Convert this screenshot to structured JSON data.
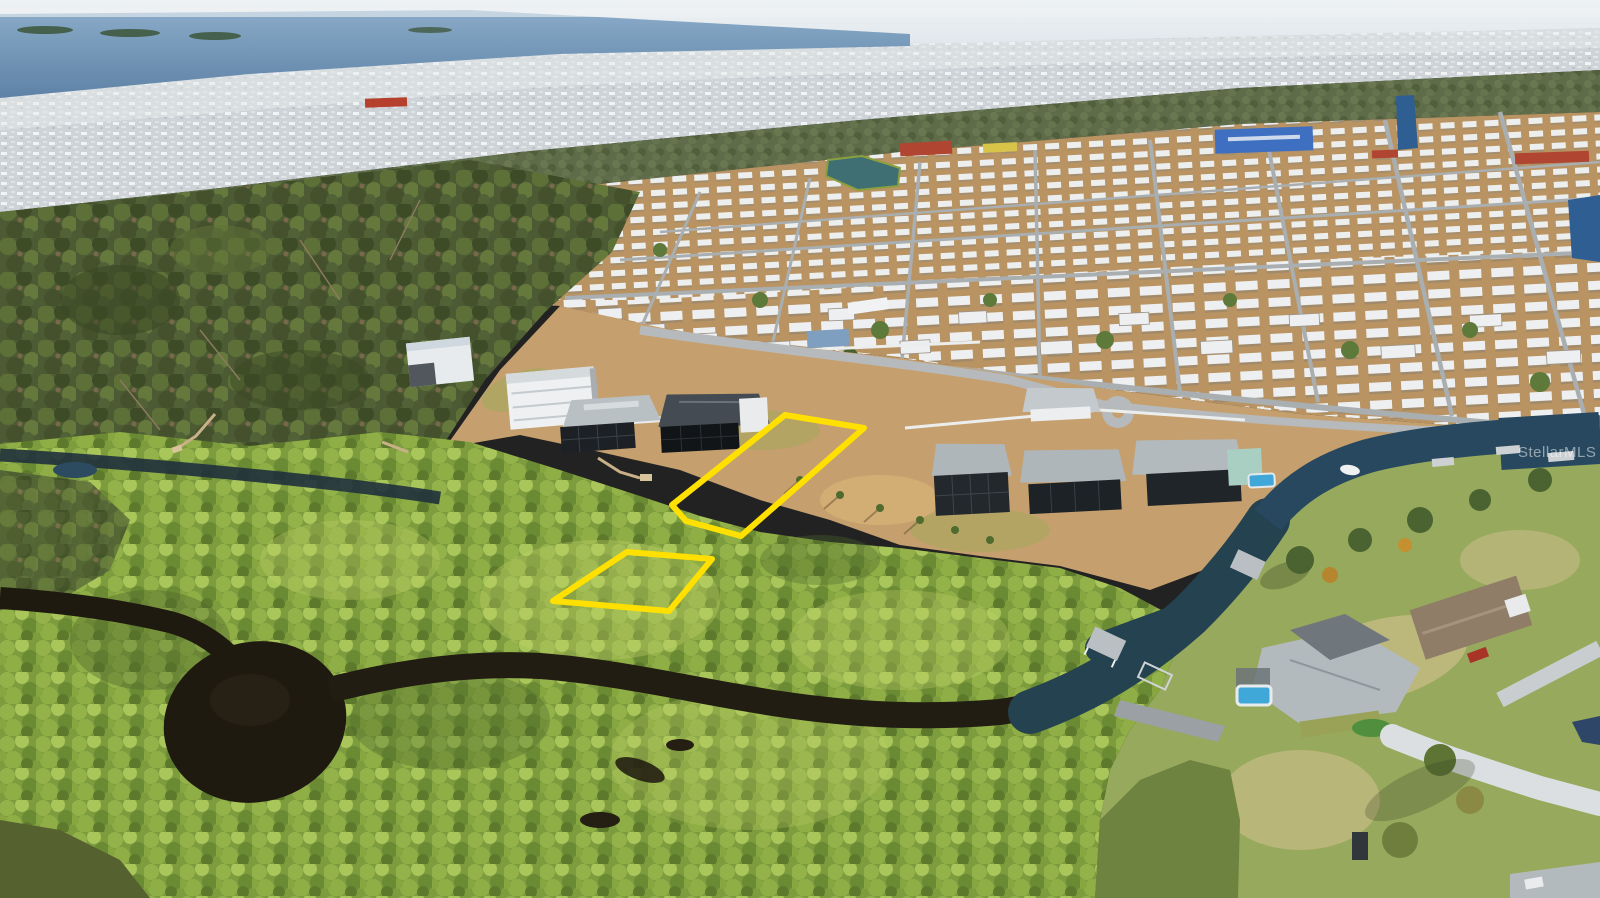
{
  "scene": {
    "type": "aerial-drone-photo",
    "watermark": {
      "text": "StellarMLS"
    },
    "highlight": {
      "color": "#FFE000",
      "lots": {
        "upper": {
          "points": "785,415 864,428 741,536 686,521 672,505"
        },
        "lower": {
          "points": "553,601 627,552 712,559 669,611"
        }
      }
    },
    "palette": {
      "sky_haze": "#E7EDF1",
      "bay_water": "#6E93B6",
      "distant_city": "#CED3D7",
      "forest": "#4C5B33",
      "park_ground": "#B99361",
      "home_roof": "#EDEFF0",
      "street": "#A9AEB1",
      "mangrove": "#7D9C3E",
      "river_water": "#1F1A10",
      "canal_water": "#27485F",
      "pool_water": "#3FA8D8",
      "lawn": "#97A95C",
      "driveway": "#DCDFE2",
      "lot_outline": "#FFE000"
    }
  }
}
